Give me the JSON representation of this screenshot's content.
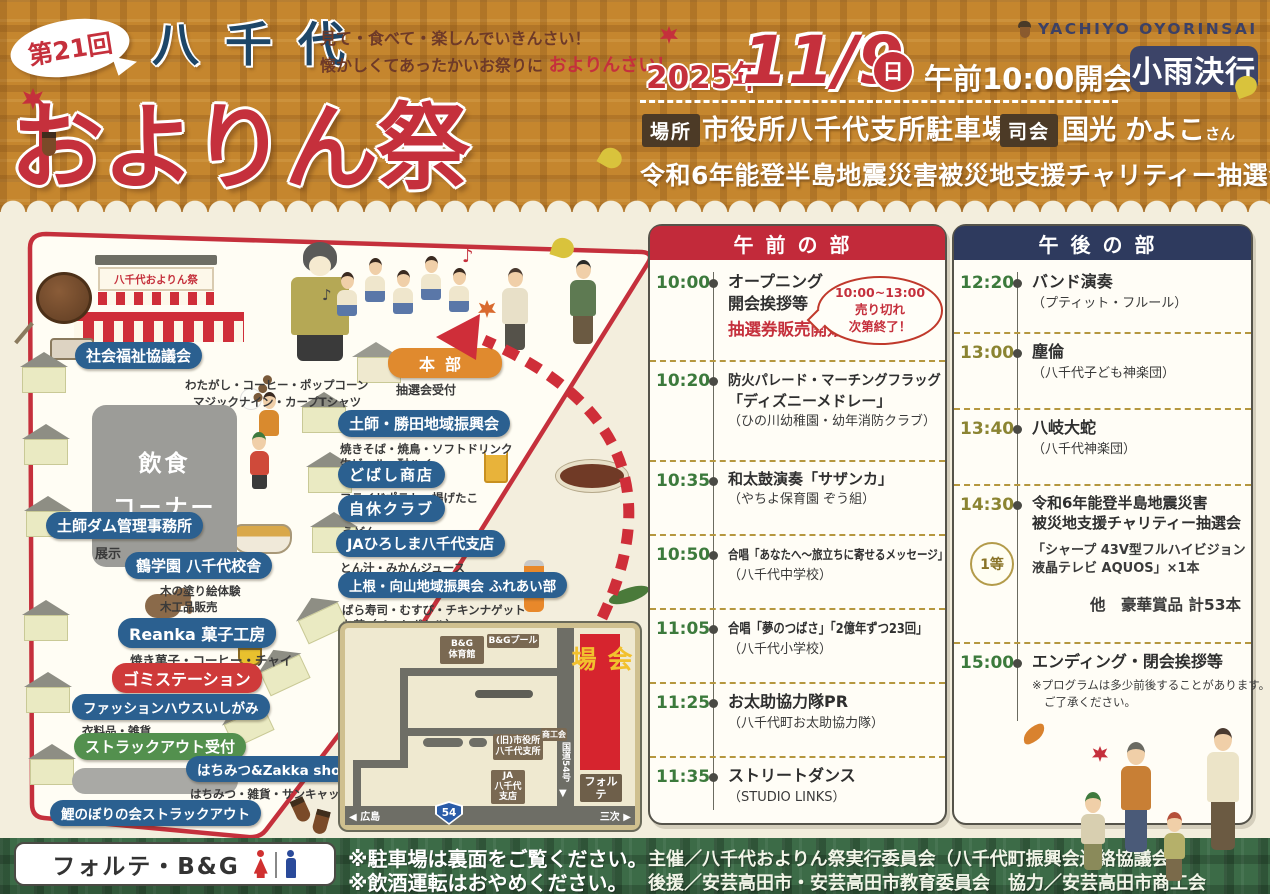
{
  "colors": {
    "accent_red": "#c5303c",
    "navy": "#2e3a5e",
    "pill_blue": "#2b6090",
    "pill_green": "#53904e",
    "pill_orange": "#e08a2e",
    "time_green": "#3c7a3c",
    "header_plaid": "#c5862e",
    "footer_plaid": "#3c6b47"
  },
  "icons": {
    "left_arrow": "◀",
    "right_arrow": "▶",
    "down_arrow": "▼",
    "music_note": "♪"
  },
  "header": {
    "edition": "第21回",
    "region": "八千代",
    "title": "およりん祭",
    "tagline_line1": "見て・食べて・楽しんでいきんさい！",
    "tagline_line2": "懐かしくてあったかいお祭りに",
    "tagline_accent": "およりんさい！",
    "logo_text": "YACHIYO OYORINSAI",
    "year": "2025年",
    "date": "11/9",
    "weekday": "日",
    "open_time": "午前10:00開会",
    "rain_badge": "小雨決行",
    "place_label": "場所",
    "place_value": "市役所八千代支所駐車場",
    "mc_label": "司会",
    "mc_value": "国光 かよこ",
    "mc_suffix": "さん",
    "charity_line": "令和6年能登半島地震災害被災地支援チャリティー抽選会"
  },
  "map": {
    "stage_banner": "八千代およりん祭",
    "food_corner_line1": "飲食",
    "food_corner_line2": "コーナー",
    "hq_label": "本部",
    "hq_sub": "抽選会受付",
    "booths": [
      {
        "label": "社会福祉協議会",
        "sub1": "わたがし・コーヒー・ポップコーン",
        "sub2": "マジックナイン・カープTシャツ"
      },
      {
        "label": "土師ダム管理事務所",
        "sub1": "展示"
      },
      {
        "label": "鶴学園 八千代校舎",
        "sub1": "木の塗り絵体験",
        "sub2": "木工品販売"
      },
      {
        "label": "Reanka 菓子工房",
        "sub1": "焼き菓子・コーヒー・チャイ"
      },
      {
        "label": "ゴミステーション"
      },
      {
        "label": "ファッションハウスいしがみ",
        "sub1": "衣料品・雑貨"
      },
      {
        "label": "ストラックアウト受付"
      },
      {
        "label": "はちみつ&Zakka shop nana",
        "sub1": "はちみつ・雑貨・サンキャッチャー"
      },
      {
        "label": "鯉のぼりの会ストラックアウト"
      },
      {
        "label": "土師・勝田地域振興会",
        "sub1": "焼きそば・焼鳥・ソフトドリンク",
        "sub2": "生ビール・酎ハイ"
      },
      {
        "label": "どばし商店",
        "sub1": "フライドポテト・揚げたこ"
      },
      {
        "label": "自休クラブ",
        "sub1": "うどん"
      },
      {
        "label": "JAひろしま八千代支店",
        "sub1": "とん汁・みかんジュース"
      },
      {
        "label": "上根・向山地域振興会 ふれあい部",
        "sub1": "ばら寿司・むすび・チキンナゲット",
        "sub2": "お茶（ペットボトル）"
      }
    ],
    "inset": {
      "gym_line1": "B&G",
      "gym_line2": "体育館",
      "pool": "B&Gプール",
      "old_office_line1": "(旧)市役所",
      "old_office_line2": "八千代支所",
      "shokokai": "商工会",
      "ja_line1": "JA",
      "ja_line2": "八千代",
      "ja_line3": "支店",
      "route_vertical": "国道54号",
      "venue": "会場",
      "forte": "フォルテ",
      "west": "広島",
      "east": "三次",
      "route_number": "54"
    }
  },
  "schedule": {
    "morning": {
      "title": "午前の部",
      "items": [
        {
          "time": "10:00",
          "line1": "オープニング",
          "line2": "開会挨拶等",
          "highlight": "抽選券販売開始",
          "bubble1": "10:00~13:00",
          "bubble2": "売り切れ",
          "bubble3": "次第終了！"
        },
        {
          "time": "10:20",
          "line1": "防火パレード・マーチングフラッグ",
          "line2": "「ディズニーメドレー」",
          "sub": "（ひの川幼稚園・幼年消防クラブ）"
        },
        {
          "time": "10:35",
          "line1": "和太鼓演奏「サザンカ」",
          "sub": "（やちよ保育園 ぞう組）"
        },
        {
          "time": "10:50",
          "line1": "合唱「あなたへ～旅立ちに寄せるメッセージ」",
          "sub": "（八千代中学校）"
        },
        {
          "time": "11:05",
          "line1": "合唱「夢のつばさ」「2億年ずつ23回」",
          "sub": "（八千代小学校）"
        },
        {
          "time": "11:25",
          "line1": "お太助協力隊PR",
          "sub": "（八千代町お太助協力隊）"
        },
        {
          "time": "11:35",
          "line1": "ストリートダンス",
          "sub": "（STUDIO LINKS）"
        }
      ]
    },
    "afternoon": {
      "title": "午後の部",
      "items": [
        {
          "time": "12:20",
          "line1": "バンド演奏",
          "sub": "（プティット・フルール）"
        },
        {
          "time": "13:00",
          "line1": "塵倫",
          "sub": "（八千代子ども神楽団）"
        },
        {
          "time": "13:40",
          "line1": "八岐大蛇",
          "sub": "（八千代神楽団）"
        },
        {
          "time": "14:30",
          "line1": "令和6年能登半島地震災害",
          "line2": "被災地支援チャリティー抽選会",
          "prize_rank": "1等",
          "prize_line1": "「シャープ 43V型フルハイビジョン",
          "prize_line2": "液晶テレビ AQUOS」×1本",
          "prize_other": "他　豪華賞品 計53本"
        },
        {
          "time": "15:00",
          "line1": "エンディング・閉会挨拶等",
          "note1": "※プログラムは多少前後することがあります。",
          "note2": "ご了承ください。"
        }
      ]
    }
  },
  "footer": {
    "facility": "フォルテ・B&G",
    "note1": "※駐車場は裏面をご覧ください。",
    "note2": "※飲酒運転はおやめください。",
    "credit1": "主催／八千代およりん祭実行委員会（八千代町振興会連絡協議会）",
    "credit2": "後援／安芸高田市・安芸高田市教育委員会　協力／安芸高田市商工会"
  }
}
